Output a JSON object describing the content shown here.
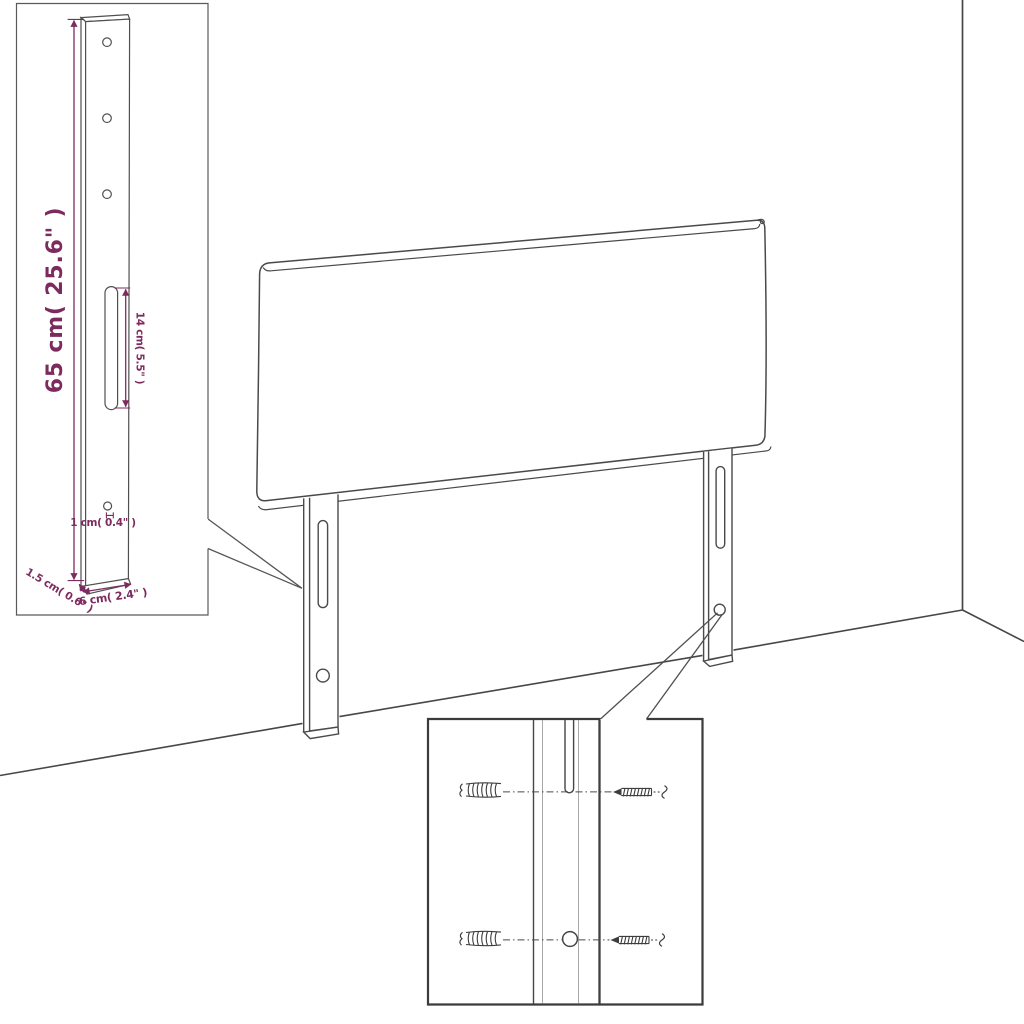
{
  "palette": {
    "background": "#ffffff",
    "line": "#4a4a4a",
    "line_bold": "#3b3b3b",
    "line_light": "#a8a8a8",
    "dimension_accent": "#7d2b5e"
  },
  "detail_inset_leg": {
    "dimensions": {
      "height": "65 cm( 25.6\" )",
      "slot_length": "14 cm( 5.5\" )",
      "hole_diameter": "1 cm( 0.4\" )",
      "thickness": "1.5 cm( 0.6\" )",
      "width": "6 cm( 2.4\" )"
    },
    "features": {
      "top_holes_count": 3,
      "slot": "mounting-slot",
      "bottom_hole": "screw-hole"
    }
  },
  "headboard": {
    "legs_count": 2,
    "slots_per_leg": 1,
    "holes_per_leg": 1
  },
  "hardware_inset": {
    "wall_plugs_count": 2,
    "screws_count": 2,
    "icons": [
      "wall-plug-icon",
      "screw-icon"
    ]
  }
}
